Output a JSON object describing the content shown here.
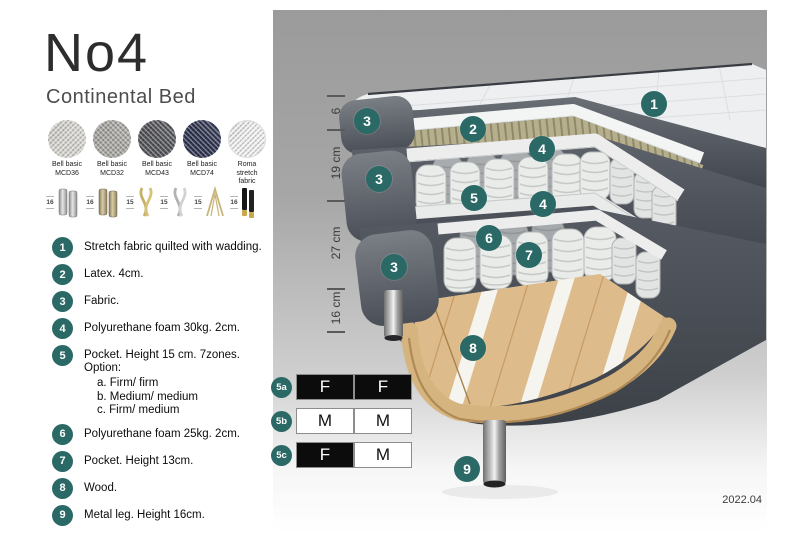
{
  "header": {
    "title": "No4",
    "subtitle": "Continental Bed"
  },
  "fabrics": [
    {
      "line1": "Bell basic",
      "line2": "MCD36"
    },
    {
      "line1": "Bell basic",
      "line2": "MCD32"
    },
    {
      "line1": "Bell basic",
      "line2": "MCD43"
    },
    {
      "line1": "Bell basic",
      "line2": "MCD74"
    },
    {
      "line1": "Roma",
      "line2": "stretch fabric"
    }
  ],
  "legs": [
    {
      "height": "16",
      "style": "cylinder-silver"
    },
    {
      "height": "16",
      "style": "cylinder-brass"
    },
    {
      "height": "15",
      "style": "wave-gold"
    },
    {
      "height": "15",
      "style": "wave-silver"
    },
    {
      "height": "15",
      "style": "hairpin-gold"
    },
    {
      "height": "16",
      "style": "tapered-black-gold"
    }
  ],
  "parts": [
    {
      "num": "1",
      "text": "Stretch fabric quilted with wadding."
    },
    {
      "num": "2",
      "text": "Latex. 4cm."
    },
    {
      "num": "3",
      "text": "Fabric."
    },
    {
      "num": "4",
      "text": "Polyurethane foam 30kg. 2cm."
    },
    {
      "num": "5",
      "text": "Pocket. Height 15 cm. 7zones. Option:",
      "options": [
        "a. Firm/ firm",
        "b. Medium/ medium",
        "c. Firm/ medium"
      ]
    },
    {
      "num": "6",
      "text": "Polyurethane foam 25kg. 2cm."
    },
    {
      "num": "7",
      "text": "Pocket. Height 13cm."
    },
    {
      "num": "8",
      "text": "Wood."
    },
    {
      "num": "9",
      "text": "Metal leg. Height 16cm."
    }
  ],
  "firmness": [
    {
      "label": "5a",
      "left": "F",
      "right": "F"
    },
    {
      "label": "5b",
      "left": "M",
      "right": "M"
    },
    {
      "label": "5c",
      "left": "F",
      "right": "M"
    }
  ],
  "measurements": [
    {
      "label": "6"
    },
    {
      "label": "19 cm"
    },
    {
      "label": "27 cm"
    },
    {
      "label": "16 cm"
    }
  ],
  "diagram_badges": [
    {
      "label": "1"
    },
    {
      "label": "2"
    },
    {
      "label": "3"
    },
    {
      "label": "3"
    },
    {
      "label": "3"
    },
    {
      "label": "4"
    },
    {
      "label": "4"
    },
    {
      "label": "5"
    },
    {
      "label": "6"
    },
    {
      "label": "7"
    },
    {
      "label": "8"
    },
    {
      "label": "9"
    }
  ],
  "footer": {
    "version": "2022.04"
  },
  "colors": {
    "badge_teal": "#2b6966",
    "fabric_dark": "#53575f",
    "latex": "#b5ae8c",
    "wood": "#ddbb8a",
    "firmness_dark_cell": "#0c0c0c"
  }
}
